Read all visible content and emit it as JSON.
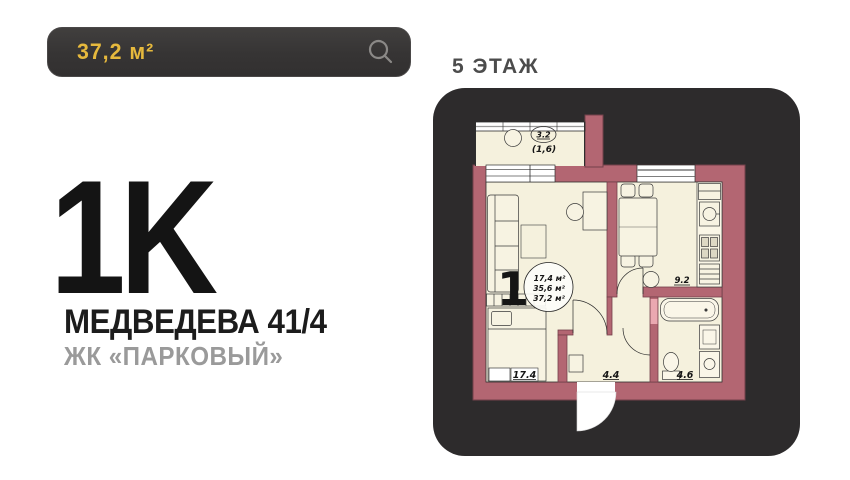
{
  "search": {
    "value": "37,2 м²"
  },
  "listing": {
    "rooms": "1K",
    "address": "МЕДВЕДЕВА 41/4",
    "complex": "ЖК «ПАРКОВЫЙ»"
  },
  "floor": {
    "label": "5 ЭТАЖ"
  },
  "plan": {
    "balcony": {
      "area": "3.2",
      "reduced": "(1,6)"
    },
    "unit": {
      "number": "1",
      "area_living": "17,4 м²",
      "area_main": "35,6 м²",
      "area_total": "37,2 м²"
    },
    "rooms": {
      "bedroom": "17.4",
      "hall": "4.4",
      "bath": "4.6",
      "kitchen": "9.2"
    }
  },
  "colors": {
    "accent_yellow": "#e6b93d",
    "wall_rose": "#b36672",
    "card_dark": "#2d2b2c",
    "room_cream": "#f5f1dd"
  }
}
